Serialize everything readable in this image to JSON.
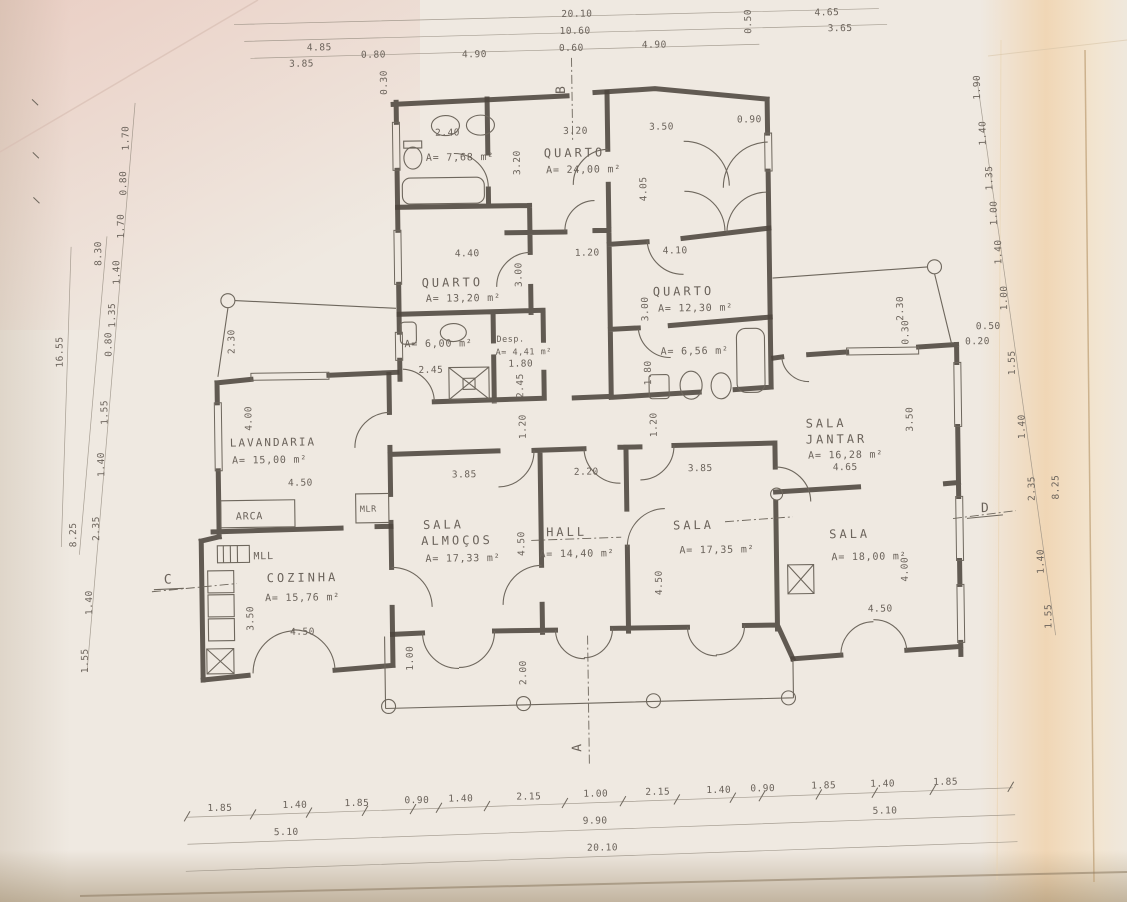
{
  "drawing": {
    "type": "scanned architectural floor plan",
    "paper_color": "#efe9e1",
    "wall_color": "#4d463d",
    "text_color": "#6b635b"
  },
  "rooms": {
    "bath_top": {
      "area": "A= 7,68 m²"
    },
    "quarto_top": {
      "name": "QUARTO",
      "area": "A= 24,00 m²"
    },
    "quarto_left": {
      "name": "QUARTO",
      "area": "A= 13,20 m²"
    },
    "quarto_right": {
      "name": "QUARTO",
      "area": "A= 12,30 m²"
    },
    "bath_mid": {
      "area": "A= 6,00 m²"
    },
    "despensa": {
      "name": "Desp.",
      "area": "A= 4,41 m²"
    },
    "bath_right": {
      "area": "A= 6,56 m²"
    },
    "lavandaria": {
      "name": "LAVANDARIA",
      "area": "A= 15,00 m²"
    },
    "cozinha": {
      "name": "COZINHA",
      "area": "A= 15,76 m²"
    },
    "sala_almocos": {
      "name1": "SALA",
      "name2": "ALMOÇOS",
      "area": "A= 17,33 m²"
    },
    "hall": {
      "name": "HALL",
      "area": "A= 14,40 m²"
    },
    "sala_central": {
      "name": "SALA",
      "area": "A= 17,35 m²"
    },
    "sala_jantar": {
      "name1": "SALA",
      "name2": "JANTAR",
      "area": "A= 16,28 m²"
    },
    "sala_estar": {
      "name": "SALA",
      "area": "A= 18,00 m²"
    },
    "labels": {
      "arca": "ARCA",
      "mlr": "MLR",
      "mll": "MLL"
    }
  },
  "section_markers": {
    "a": "A",
    "b": "B",
    "c": "C",
    "d": "D"
  },
  "dims": {
    "top_overall": "20.10",
    "top_wing": "10.60",
    "top_row": [
      "4.85",
      "3.85",
      "0.80",
      "4.90",
      "0.60",
      "4.90",
      "4.65",
      "3.65"
    ],
    "top_rot": [
      "0.30",
      "0.50"
    ],
    "bottom_row": [
      "1.85",
      "1.40",
      "1.85",
      "0.90",
      "1.40",
      "2.15",
      "1.00",
      "2.15",
      "1.40",
      "0.90",
      "1.85",
      "1.40",
      "1.85"
    ],
    "bottom_groups": [
      "5.10",
      "9.90",
      "5.10"
    ],
    "bottom_overall": "20.10",
    "left_chain": [
      "1.70",
      "0.80",
      "1.70",
      "1.40",
      "1.35",
      "0.80",
      "1.55",
      "1.40",
      "2.35",
      "1.40",
      "1.55"
    ],
    "left_group_top": "8.30",
    "left_group_bottom": "8.25",
    "left_overall": "16.55",
    "right_chain": [
      "1.90",
      "1.40",
      "1.35",
      "1.00",
      "1.40",
      "1.00",
      "1.55",
      "1.40",
      "2.35",
      "1.40",
      "1.55"
    ],
    "right_group": "8.25",
    "right_offsets": [
      "0.50",
      "0.20",
      "2.30",
      "0.30"
    ],
    "interior": {
      "bath_top_w": "2.40",
      "quarto_top_w": "3.20",
      "entry_w": "3.50",
      "entry_door": "0.90",
      "quarto_top_h": "3.20",
      "entry_h": "4.05",
      "quarto_left_w": "4.40",
      "corridor_w": "1.20",
      "quarto_right_w": "4.10",
      "quarto_left_h": "3.00",
      "quarto_right_h": "3.00",
      "bath_mid_w": "2.45",
      "desp_w": "1.80",
      "desp_h": "2.45",
      "bath_right_h": "1.80",
      "corr_left_h": "1.20",
      "corr_right_h": "1.20",
      "lav_wall": "2.30",
      "lav_h": "4.00",
      "lav_w": "4.50",
      "almocos_w": "3.85",
      "hall_w": "2.20",
      "sala_w": "3.85",
      "jantar_w": "4.65",
      "jantar_h": "3.50",
      "almocos_h": "4.50",
      "sala_h": "4.50",
      "cozinha_h": "3.50",
      "cozinha_w": "4.50",
      "estar_w": "4.50",
      "estar_h": "4.00",
      "porch_step": "1.00",
      "porch_depth": "2.00"
    }
  }
}
